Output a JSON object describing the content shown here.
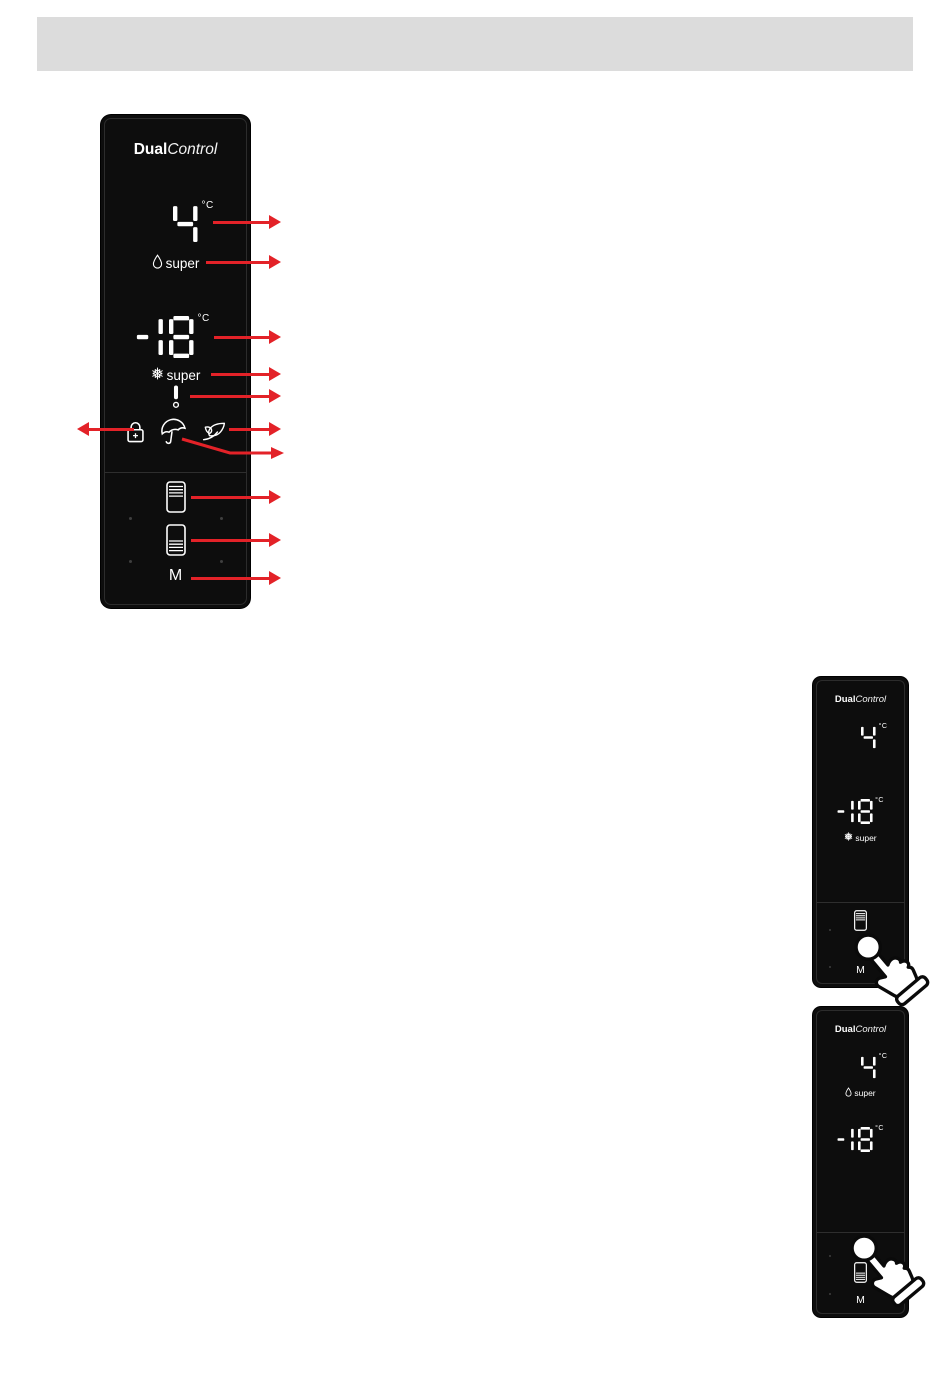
{
  "colors": {
    "header_bar": "#dcdcdc",
    "panel_background": "#0d0d0d",
    "display_text": "#ffffff",
    "arrow_red": "#e32228"
  },
  "brand": {
    "name_bold": "Dual",
    "name_italic": "Control"
  },
  "panels": {
    "main": {
      "fridge_temp": "4",
      "fridge_unit": "°C",
      "fridge_super_label": "super",
      "freezer_temp": "-18",
      "freezer_unit": "°C",
      "freezer_super_label": "super",
      "mode_label": "M",
      "indicator_icons": [
        "droplet-icon",
        "snowflake-icon",
        "alarm-icon",
        "key-lock-icon",
        "holiday-umbrella-icon",
        "eco-leaf-icon"
      ],
      "button_icons": [
        "fridge-compartment-icon",
        "freezer-compartment-icon"
      ]
    },
    "freezer_super_example": {
      "fridge_temp": "4",
      "fridge_unit": "°C",
      "freezer_temp": "-18",
      "freezer_unit": "°C",
      "freezer_super_label": "super",
      "mode_label": "M",
      "gesture_icon": "tap-hand-icon"
    },
    "fridge_super_example": {
      "fridge_temp": "4",
      "fridge_unit": "°C",
      "fridge_super_label": "super",
      "freezer_temp": "-18",
      "freezer_unit": "°C",
      "mode_label": "M",
      "gesture_icon": "tap-hand-icon"
    }
  },
  "annotations": {
    "arrow_targets_right": [
      "fridge-temperature-display",
      "fridge-super-indicator",
      "freezer-temperature-display",
      "freezer-super-indicator",
      "alarm-indicator",
      "eco-indicator",
      "holiday-indicator",
      "fridge-set-button",
      "freezer-set-button",
      "mode-button"
    ],
    "arrow_targets_left": [
      "key-lock-indicator"
    ]
  }
}
